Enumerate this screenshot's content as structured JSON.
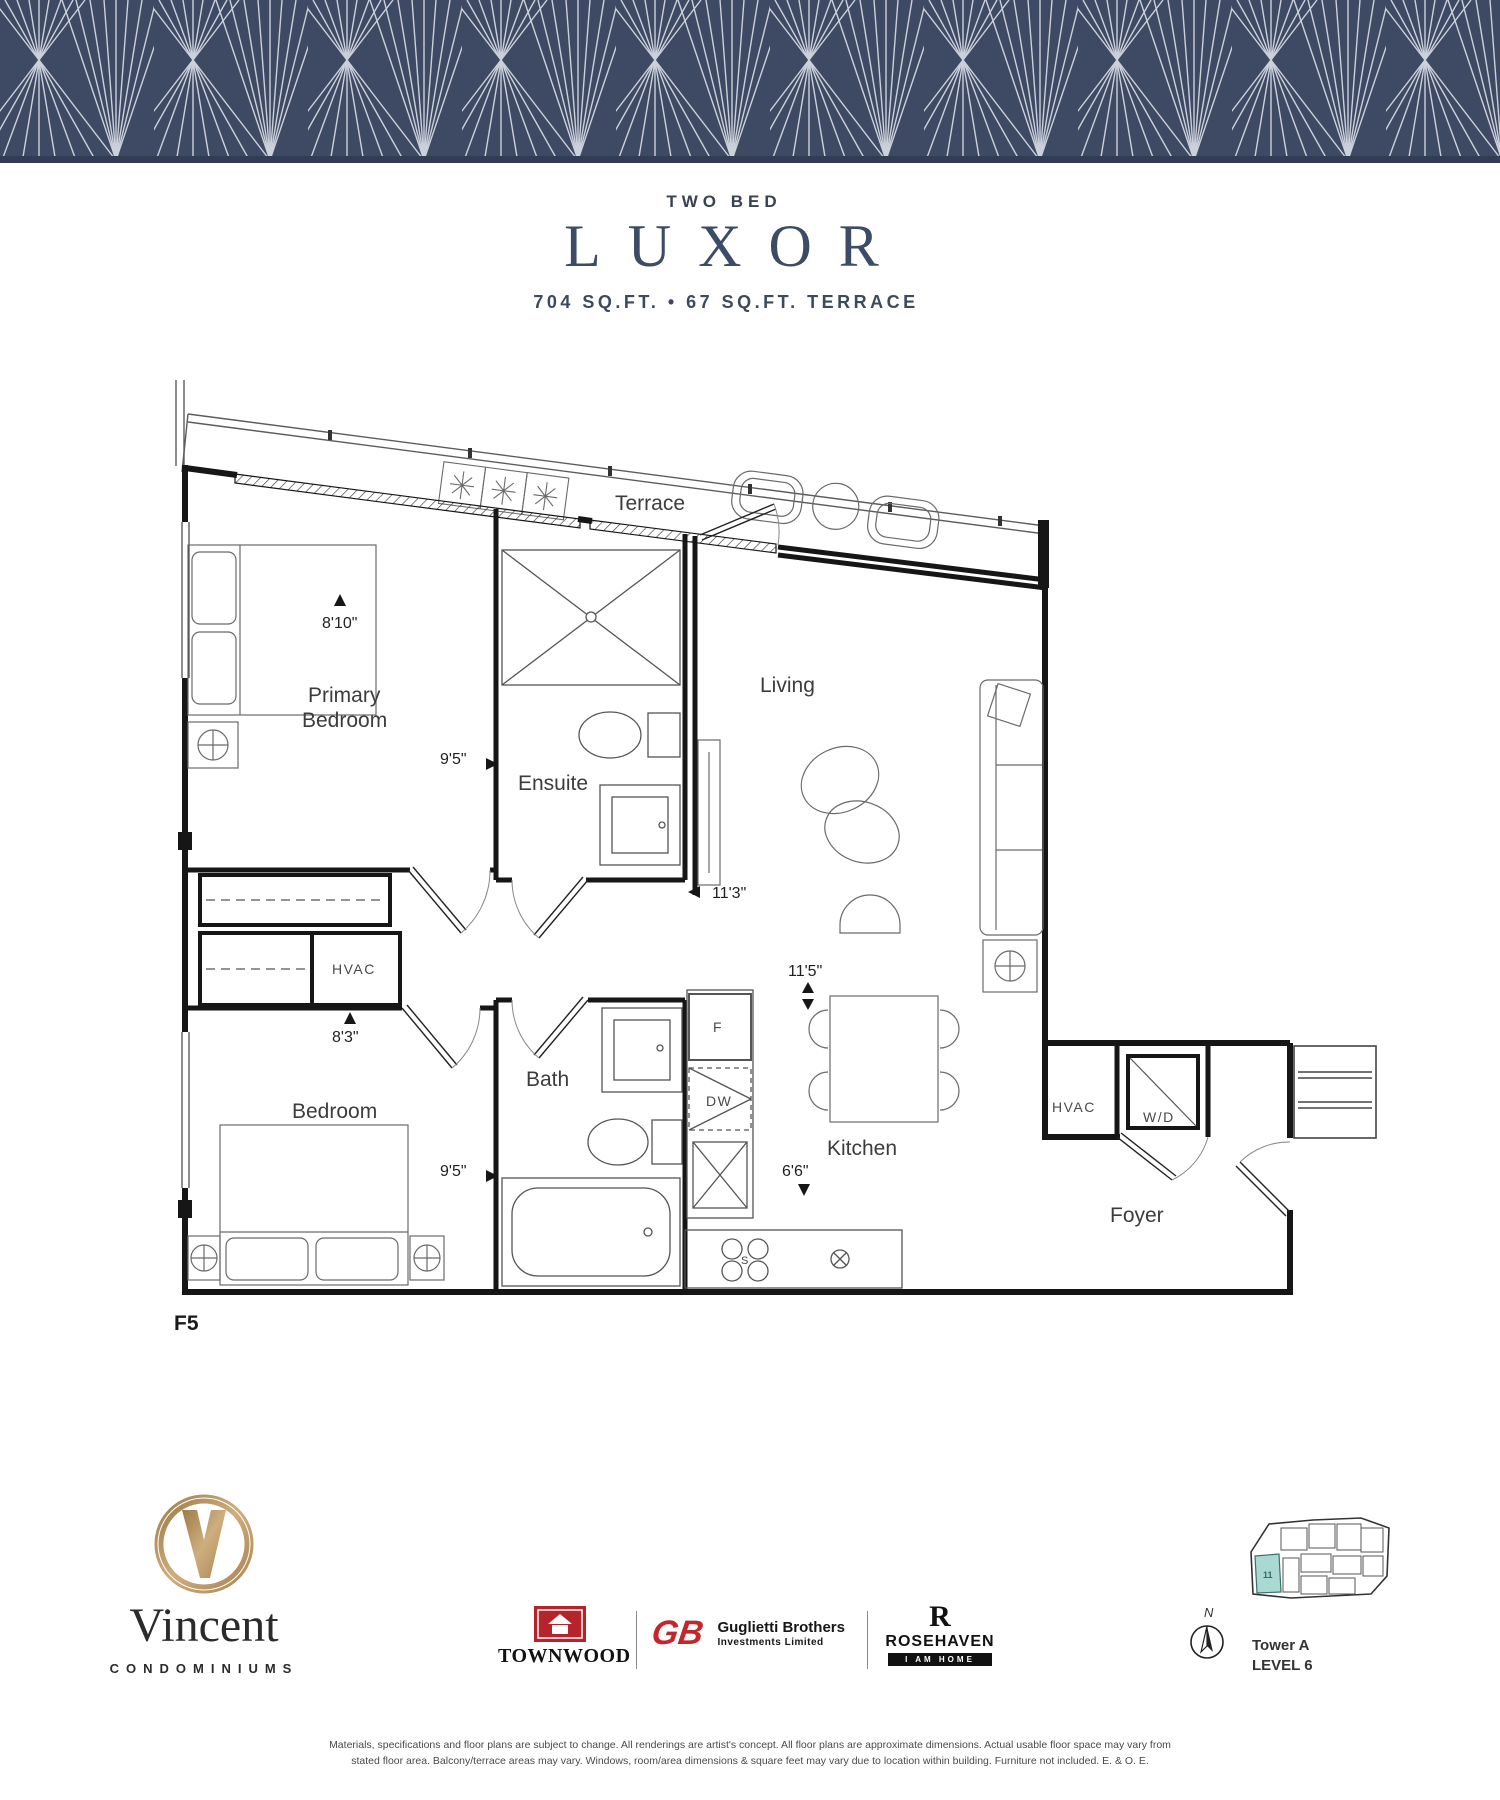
{
  "title": {
    "eyebrow": "TWO BED",
    "name": "LUXOR",
    "area": "704 SQ.FT. • 67 SQ.FT. TERRACE"
  },
  "plan": {
    "unit_code": "F5",
    "labels": {
      "terrace": "Terrace",
      "primary_line1": "Primary",
      "primary_line2": "Bedroom",
      "ensuite": "Ensuite",
      "living": "Living",
      "hvac_closet": "HVAC",
      "bedroom": "Bedroom",
      "bath": "Bath",
      "kitchen": "Kitchen",
      "hvac_foyer": "HVAC",
      "wd": "W/D",
      "foyer": "Foyer"
    },
    "dims": {
      "primary_width": "8'10\"",
      "ensuite_depth": "9'5\"",
      "living_width": "11'3\"",
      "bedroom_width": "8'3\"",
      "kitchen_width": "11'5\"",
      "bath_depth": "9'5\"",
      "kitchen_depth": "6'6\""
    },
    "appliances": {
      "fridge": "F",
      "dishwasher": "DW",
      "stove": "S"
    }
  },
  "footer": {
    "vincent": {
      "monogram": "V",
      "name": "Vincent",
      "sub": "CONDOMINIUMS"
    },
    "townwood": {
      "name": "TOWNWOOD"
    },
    "guglietti": {
      "monogram": "GB",
      "line1": "Guglietti Brothers",
      "line2": "Investments Limited"
    },
    "rosehaven": {
      "monogram": "R",
      "name": "ROSEHAVEN",
      "tagline": "I AM HOME"
    },
    "north_label": "N",
    "keyplan": {
      "unit": "11",
      "tower": "Tower A",
      "level": "LEVEL 6"
    },
    "disclaimer_line1": "Materials, specifications and floor plans are subject to change. All renderings are artist's concept. All floor plans are approximate dimensions. Actual usable floor space may vary from",
    "disclaimer_line2": "stated floor area. Balcony/terrace areas may vary. Windows, room/area dimensions & square feet may vary due to location within building. Furniture not included. E. & O. E."
  },
  "colors": {
    "banner_navy": "#3E4A63",
    "banner_line": "#D8DCE5",
    "keyplan_unit": "#A9D9D2",
    "logo_red": "#B5242B",
    "logo_gold": "#B5925F"
  }
}
